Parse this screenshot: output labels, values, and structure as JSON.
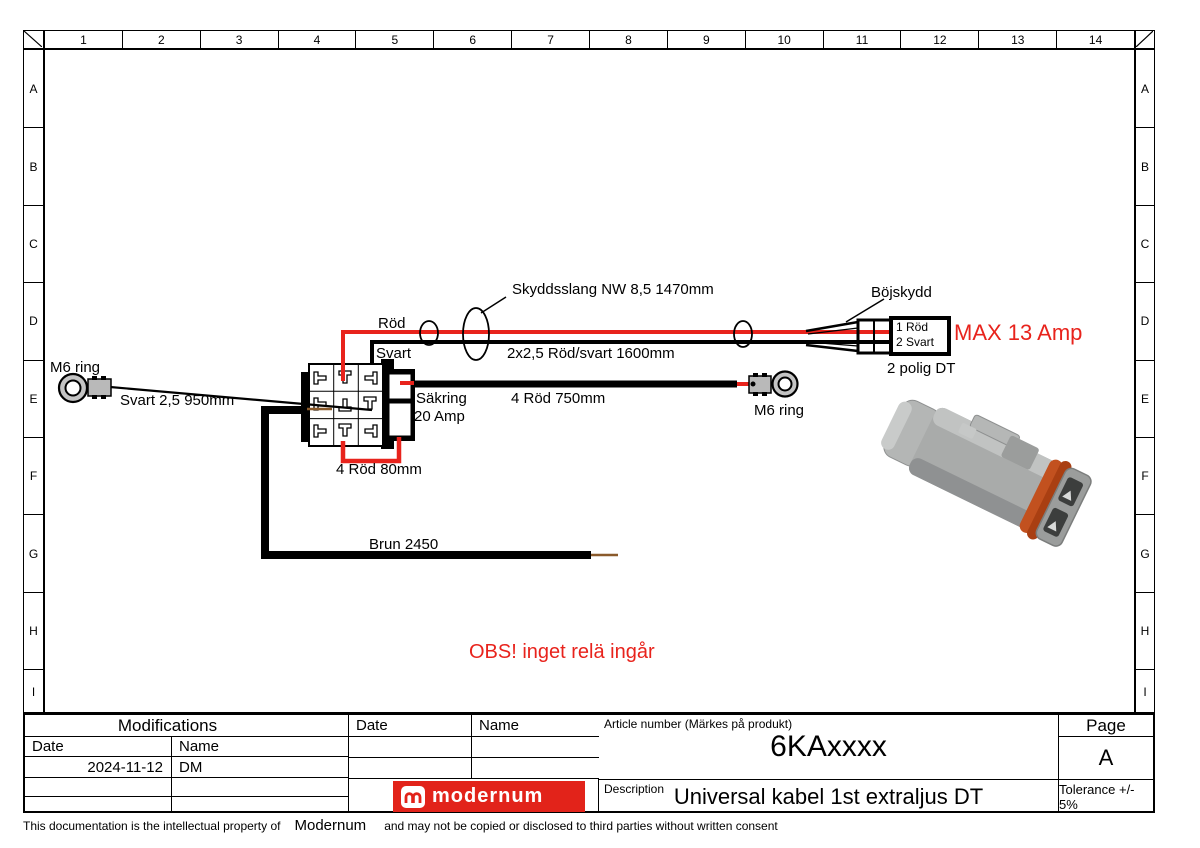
{
  "frame": {
    "columns": [
      "1",
      "2",
      "3",
      "4",
      "5",
      "6",
      "7",
      "8",
      "9",
      "10",
      "11",
      "12",
      "13",
      "14"
    ],
    "rows": [
      "A",
      "B",
      "C",
      "D",
      "E",
      "F",
      "G",
      "H",
      "I"
    ]
  },
  "diagram": {
    "labels": {
      "m6_ring_left": "M6 ring",
      "svart_950": "Svart 2,5 950mm",
      "rod": "Röd",
      "svart": "Svart",
      "skyddsslang": "Skyddsslang NW 8,5 1470mm",
      "par_1600": "2x2,5 Röd/svart 1600mm",
      "sakring_1": "Säkring",
      "sakring_2": "20 Amp",
      "rod_750": "4 Röd 750mm",
      "rod_80": "4 Röd 80mm",
      "m6_ring_right": "M6 ring",
      "bojskydd": "Böjskydd",
      "pin_1": "1 Röd",
      "pin_2": "2 Svart",
      "max_amp": "MAX 13 Amp",
      "polig_dt": "2 polig DT",
      "brun_2450": "Brun 2450",
      "obs_warning": "OBS! inget relä ingår"
    },
    "colors": {
      "wire_red": "#e8231c",
      "wire_brown": "#8a5a2b",
      "warning_red": "#e8231c",
      "logo_red": "#e2231a"
    }
  },
  "title_block": {
    "modifications": {
      "title": "Modifications",
      "date_header": "Date",
      "name_header": "Name",
      "rows": [
        {
          "date": "2024-11-12",
          "name": "DM"
        }
      ]
    },
    "approval": {
      "date_header": "Date",
      "name_header": "Name"
    },
    "article": {
      "label": "Article number (Märkes på produkt)",
      "value": "6KAxxxx"
    },
    "description": {
      "label": "Description",
      "value": "Universal kabel 1st extraljus DT"
    },
    "page": {
      "label": "Page",
      "value": "A"
    },
    "tolerance": "Tolerance +/- 5%",
    "logo_text": "modernum"
  },
  "footer": {
    "part1": "This documentation is the intellectual property of",
    "company": "Modernum",
    "part2": "and may not be copied or disclosed to third parties without written consent"
  }
}
